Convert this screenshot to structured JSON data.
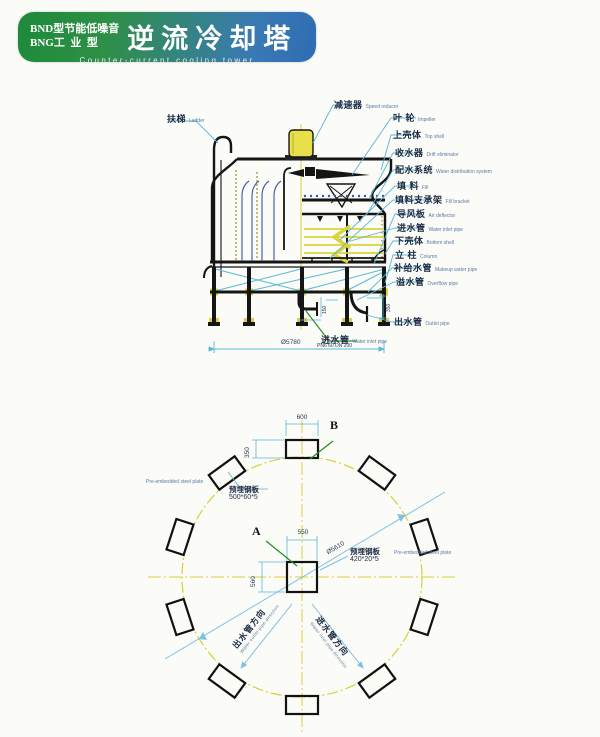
{
  "header": {
    "line1": "BND型节能低噪音",
    "line2": "BNG工  业  型",
    "title": "逆流冷却塔",
    "subtitle": "Counter-current cooling tower",
    "gradient_left": "#1d8a3a",
    "gradient_right": "#2f6cb3"
  },
  "section_diagram": {
    "labels_right": [
      {
        "cn": "减速器",
        "en": "Speed reducer"
      },
      {
        "cn": "叶 轮",
        "en": "Impeller"
      },
      {
        "cn": "上壳体",
        "en": "Top shell"
      },
      {
        "cn": "收水器",
        "en": "Drift eliminator"
      },
      {
        "cn": "配水系统",
        "en": "Water distribution system"
      },
      {
        "cn": "填 料",
        "en": "Fill"
      },
      {
        "cn": "填料支承架",
        "en": "Fill bracket"
      },
      {
        "cn": "导风板",
        "en": "Air deflector"
      },
      {
        "cn": "进水管",
        "en": "Water inlet pipe"
      },
      {
        "cn": "下壳体",
        "en": "Bottom shell"
      },
      {
        "cn": "立 柱",
        "en": "Column"
      },
      {
        "cn": "补给水管",
        "en": "Makeup water pipe"
      },
      {
        "cn": "溢水管",
        "en": "Overflow pipe"
      },
      {
        "cn": "出水管",
        "en": "Outlet pipe"
      }
    ],
    "label_ladder": {
      "cn": "扶梯",
      "en": "Ladder"
    },
    "label_inlet_bottom": {
      "cn": "进水管",
      "en": "Water inlet pipe",
      "spec": "PN6 60 DN 200"
    },
    "dims": {
      "overall": "Ø5780",
      "d150": "150",
      "d350": "350"
    },
    "colors": {
      "leader": "#58b8d4",
      "line_art": "#1a1a1a",
      "accent_yellow": "#dcd338",
      "panel_blue": "#3a55a8",
      "green_leader": "#2e8b2e"
    }
  },
  "plan_diagram": {
    "label_A": "A",
    "label_B": "B",
    "dims": {
      "top_width": "600",
      "top_height": "350",
      "center_width": "550",
      "center_height": "560",
      "circle": "Ø5610"
    },
    "plate_outer": {
      "cn": "预埋钢板",
      "size": "500*60*5",
      "en": "Pre-embedded steel plate"
    },
    "plate_center": {
      "cn": "预埋钢板",
      "size": "420*20*5",
      "en": "Pre-embedded steel plate"
    },
    "outlet_dir": {
      "cn": "出水管方向",
      "en": "Water outlet pipe direction"
    },
    "inlet_dir": {
      "cn": "进水管方向",
      "en": "Water inlet pipe direction"
    },
    "colors": {
      "centerline_yellow": "#d8cf3a",
      "dim_blue": "#7cc0e4"
    }
  }
}
